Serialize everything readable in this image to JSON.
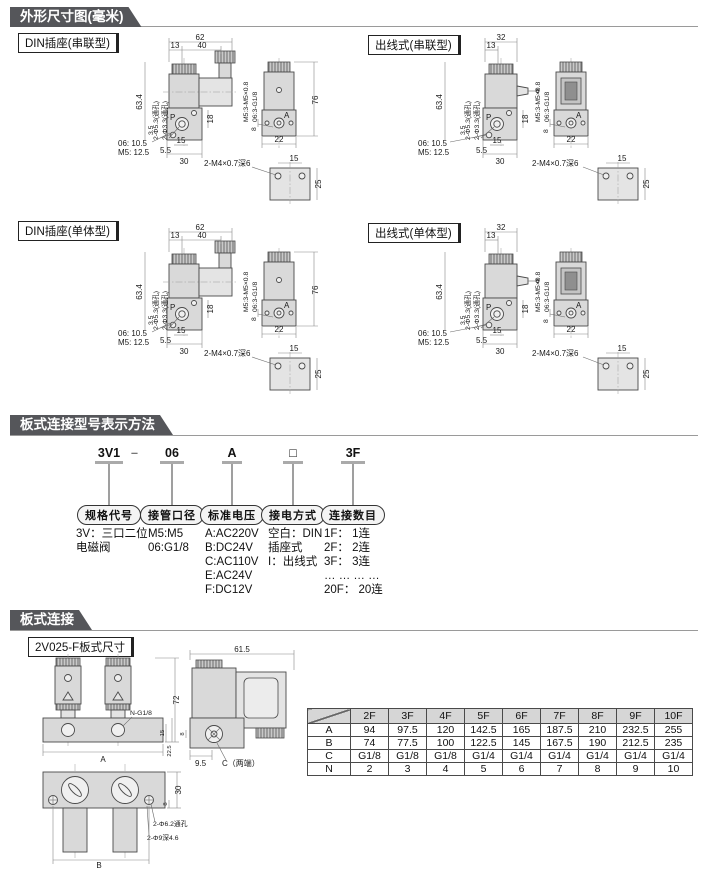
{
  "page": {
    "section1_title": "外形尺寸图(毫米)",
    "section2_title": "板式连接型号表示方法",
    "section3_title": "板式连接"
  },
  "drawings": {
    "din_series_label": "DIN插座(串联型)",
    "wire_series_label": "出线式(串联型)",
    "din_single_label": "DIN插座(单体型)",
    "wire_single_label": "出线式(单体型)"
  },
  "din": {
    "w62": "62",
    "d13": "13",
    "d40": "40",
    "h634": "63.4",
    "hole53": "2-Φ5.3(通孔)",
    "hole33": "2-Φ3.3(通孔)",
    "d35": "3.5",
    "p": "P",
    "d18": "18",
    "n06": "06: 10.5",
    "nm5": "M5: 12.5",
    "d55": "5.5",
    "d15": "15",
    "d30": "30",
    "side_m5": "M5:3-M5×0.8",
    "side_06": "06:3-G1/8",
    "d76": "76",
    "d8": "8",
    "d22": "22",
    "a": "A"
  },
  "wire": {
    "w32": "32",
    "d13": "13",
    "h634": "63.4",
    "hole53": "2-Φ5.3(通孔)",
    "hole33": "2-Φ3.3(通孔)",
    "d35": "3.5",
    "p": "P",
    "d18": "18",
    "n06": "06: 10.5",
    "nm5": "M5: 12.5",
    "d55": "5.5",
    "d15": "15",
    "d30": "30",
    "side_m5": "M5:3-M5×0.8",
    "side_06": "06:3-G1/8",
    "d8": "8",
    "d22": "22",
    "a": "A"
  },
  "foot": {
    "label": "2-M4×0.7深6",
    "d15": "15",
    "d25": "25"
  },
  "model": {
    "codes": [
      "3V1",
      "–",
      "06",
      "A",
      "□",
      "3F"
    ],
    "bubbles": [
      "规格代号",
      "接管口径",
      "标准电压",
      "接电方式",
      "连接数目"
    ],
    "spec": [
      "3V：三口二位",
      "电磁阀"
    ],
    "port": [
      "M5:M5",
      "06:G1/8"
    ],
    "voltage": [
      "A:AC220V",
      "B:DC24V",
      "C:AC110V",
      "E:AC24V",
      "F:DC12V"
    ],
    "electric": [
      "空白：DIN",
      "插座式",
      "I：出线式"
    ],
    "count": [
      "1F： 1连",
      "2F： 2连",
      "3F： 3连",
      "… … … …",
      "20F： 20连"
    ]
  },
  "plate": {
    "label": "2V025-F板式尺寸",
    "front": {
      "d72": "72",
      "ng18": "N-G1/8",
      "a": "A",
      "d15": "15",
      "d225": "22.5"
    },
    "side": {
      "d615": "61.5",
      "d95": "9.5",
      "c": "C（两端）",
      "d8": "8"
    },
    "bottom": {
      "d30": "30",
      "d8": "8",
      "hole62": "2-Φ6.2通孔",
      "hole9": "2-Φ9深4.6",
      "b": "B"
    }
  },
  "table": {
    "corner": "",
    "cols": [
      "2F",
      "3F",
      "4F",
      "5F",
      "6F",
      "7F",
      "8F",
      "9F",
      "10F"
    ],
    "rows": [
      {
        "h": "A",
        "v": [
          "94",
          "97.5",
          "120",
          "142.5",
          "165",
          "187.5",
          "210",
          "232.5",
          "255"
        ]
      },
      {
        "h": "B",
        "v": [
          "74",
          "77.5",
          "100",
          "122.5",
          "145",
          "167.5",
          "190",
          "212.5",
          "235"
        ]
      },
      {
        "h": "C",
        "v": [
          "G1/8",
          "G1/8",
          "G1/8",
          "G1/4",
          "G1/4",
          "G1/4",
          "G1/4",
          "G1/4",
          "G1/4"
        ]
      },
      {
        "h": "N",
        "v": [
          "2",
          "3",
          "4",
          "5",
          "6",
          "7",
          "8",
          "9",
          "10"
        ]
      }
    ]
  }
}
